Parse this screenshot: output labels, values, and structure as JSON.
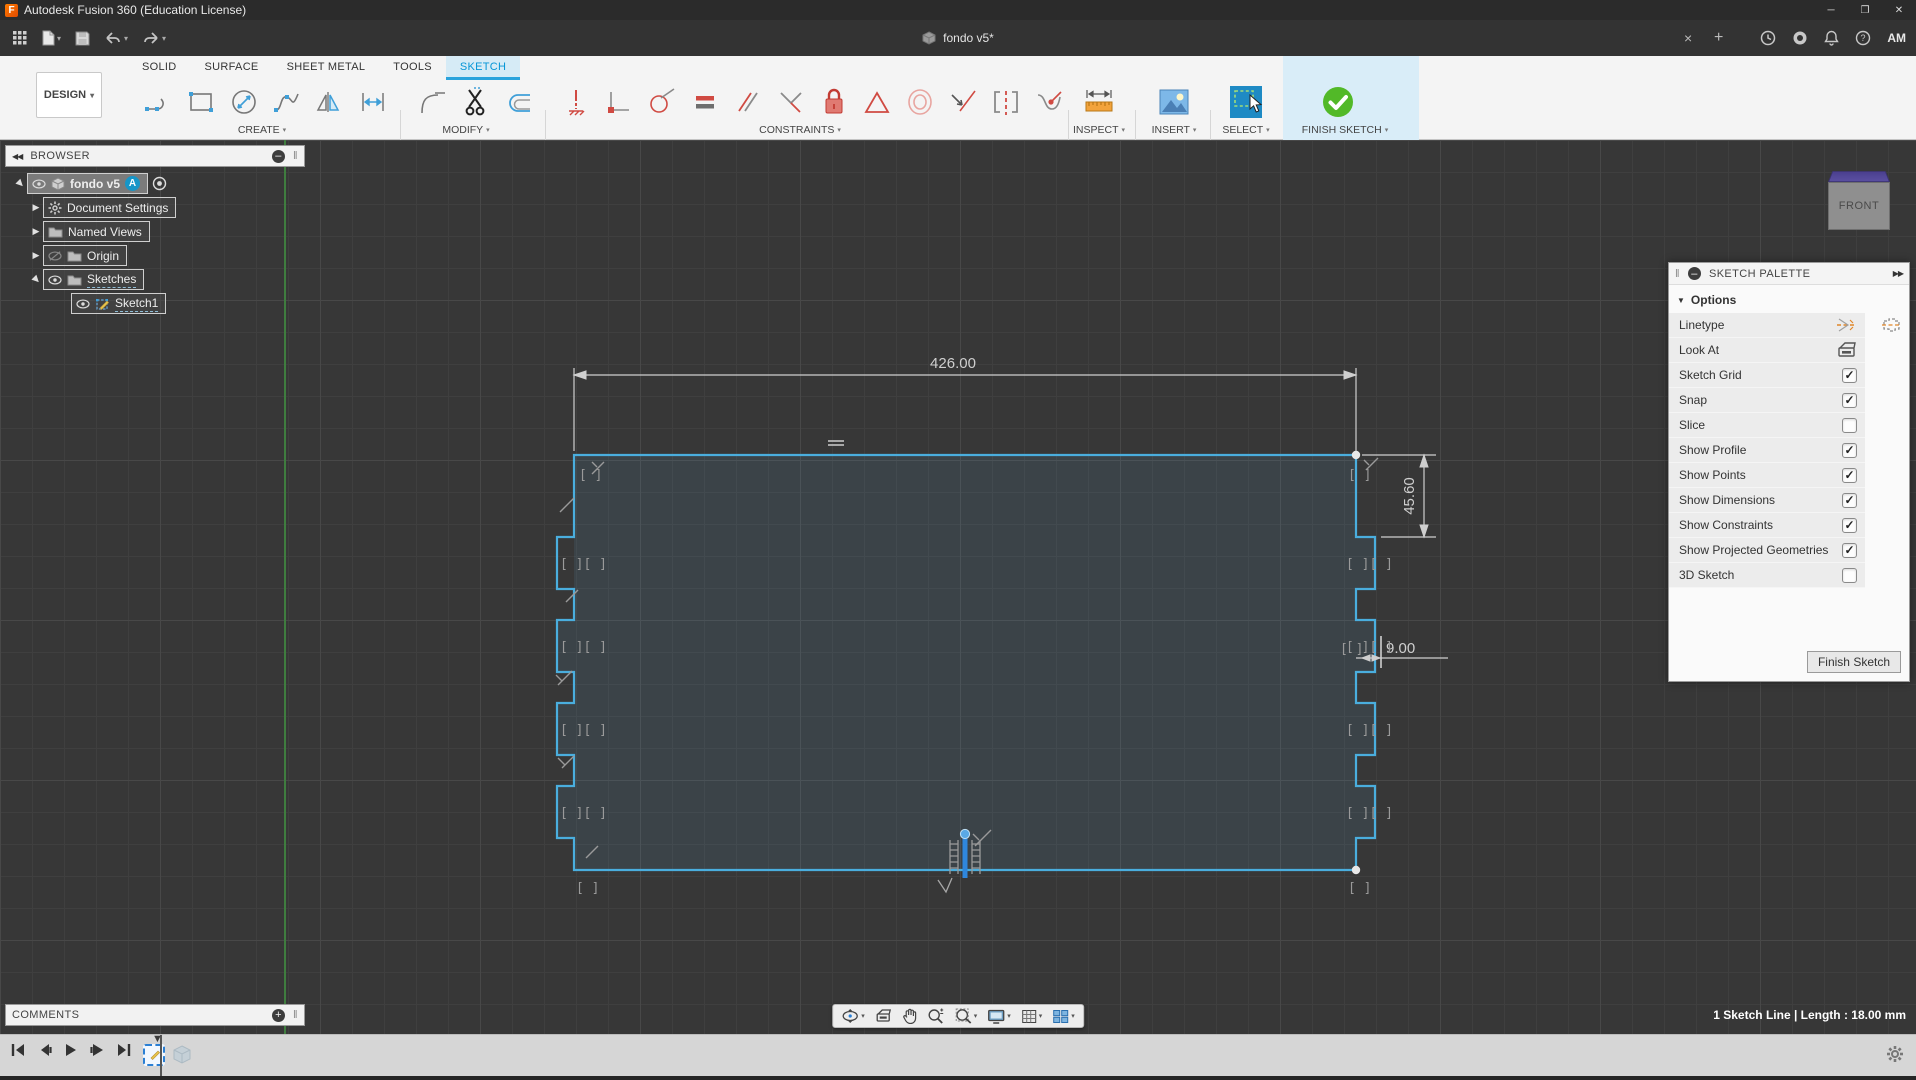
{
  "glyphs": {
    "dropdown": "▾",
    "double_right": "▶▶",
    "double_left": "◀◀",
    "minimize": "─",
    "maximize": "❐",
    "close": "✕",
    "tab_close": "×",
    "tab_new": "+",
    "check": "✓",
    "collapsed_arrow": "▶",
    "expanded_arrow": "◢",
    "marker_down": "▼",
    "section_down": "▼",
    "grip": "‖",
    "minus": "–",
    "plus": "+",
    "logo_letter": "F",
    "question": "?"
  },
  "window": {
    "title": "Autodesk Fusion 360 (Education License)",
    "user_initials": "AM"
  },
  "document_tab": {
    "title": "fondo v5*"
  },
  "workspace_button": {
    "label": "DESIGN"
  },
  "ribbon": {
    "tabs": [
      {
        "label": "SOLID"
      },
      {
        "label": "SURFACE"
      },
      {
        "label": "SHEET METAL"
      },
      {
        "label": "TOOLS"
      },
      {
        "label": "SKETCH"
      }
    ],
    "active_tab": "SKETCH",
    "groups": [
      {
        "label": "CREATE"
      },
      {
        "label": "MODIFY"
      },
      {
        "label": "CONSTRAINTS"
      },
      {
        "label": "INSPECT"
      },
      {
        "label": "INSERT"
      },
      {
        "label": "SELECT"
      },
      {
        "label": "FINISH SKETCH"
      }
    ]
  },
  "browser": {
    "title": "BROWSER",
    "items": [
      {
        "label": "fondo v5",
        "badge": "A"
      },
      {
        "label": "Document Settings"
      },
      {
        "label": "Named Views"
      },
      {
        "label": "Origin"
      },
      {
        "label": "Sketches"
      },
      {
        "label": "Sketch1"
      }
    ]
  },
  "comments": {
    "title": "COMMENTS"
  },
  "sketch_palette": {
    "title": "SKETCH PALETTE",
    "section": "Options",
    "rows": [
      {
        "label": "Linetype"
      },
      {
        "label": "Look At"
      },
      {
        "label": "Sketch Grid",
        "checked": true
      },
      {
        "label": "Snap",
        "checked": true
      },
      {
        "label": "Slice",
        "checked": false
      },
      {
        "label": "Show Profile",
        "checked": true
      },
      {
        "label": "Show Points",
        "checked": true
      },
      {
        "label": "Show Dimensions",
        "checked": true
      },
      {
        "label": "Show Constraints",
        "checked": true
      },
      {
        "label": "Show Projected Geometries",
        "checked": true
      },
      {
        "label": "3D Sketch",
        "checked": false
      }
    ],
    "finish_button": "Finish Sketch"
  },
  "viewcube": {
    "face": "FRONT"
  },
  "canvas": {
    "dimensions": {
      "width": "426.00",
      "height": "45.60",
      "tab": "9.00"
    },
    "constraint_glyph": "[ ][ ]",
    "corner_glyph": "[ ]",
    "single_glyph": "[ ]"
  },
  "status_bar": {
    "selection": "1 Sketch Line | Length : 18.00 mm"
  },
  "colors": {
    "accent": "#0696d7",
    "sketch_line": "#4aaede",
    "selected_line": "#2f87dd",
    "finish_green": "#52b928",
    "constraint_red": "#d04a42",
    "canvas_bg": "#373737"
  }
}
